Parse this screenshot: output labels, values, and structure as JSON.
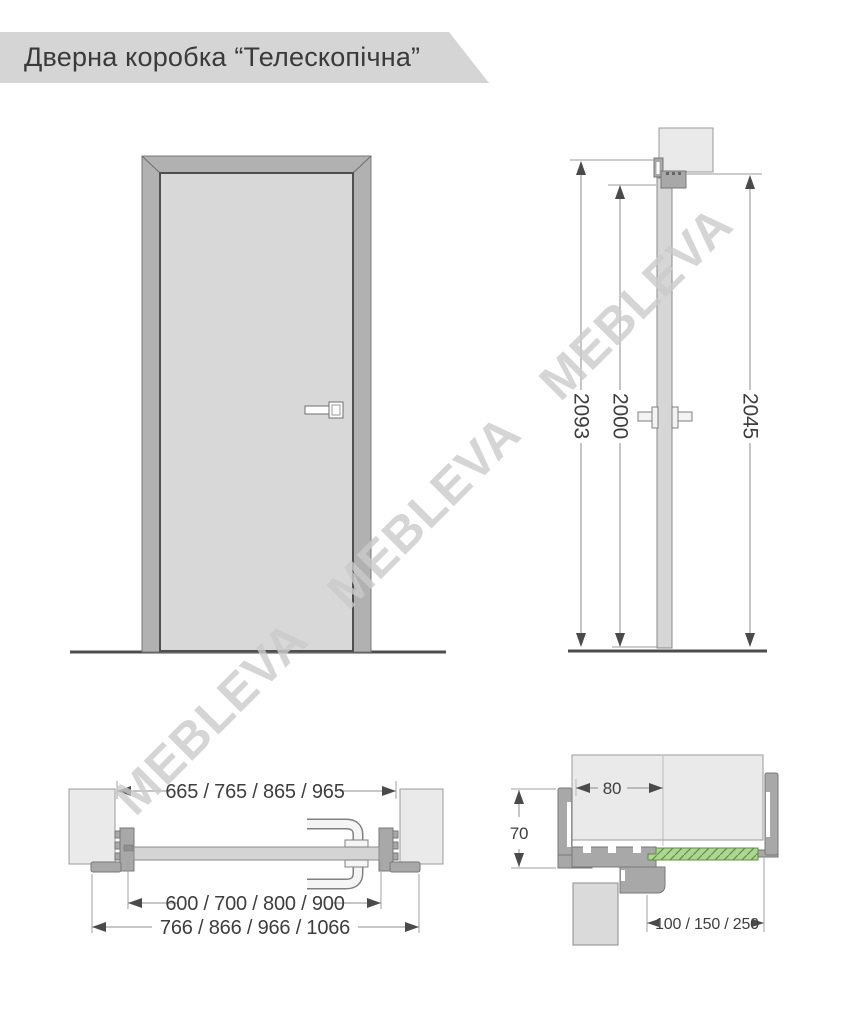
{
  "header": {
    "title": "Дверна коробка “Телескопічна”"
  },
  "watermark": {
    "text": "MEBLEVA"
  },
  "views": {
    "side": {
      "dim_frame_height": "2093",
      "dim_opening_height": "2000",
      "dim_door_height": "2045"
    },
    "plan": {
      "dim_frame_width": "665 / 765 / 865 / 965",
      "dim_door_width": "600 / 700 / 800 / 900",
      "dim_overall_width": "766 / 866 / 966 / 1066"
    },
    "detail": {
      "dim_frame_depth": "80",
      "dim_casing_width": "70",
      "dim_extension_width": "100 / 150 / 250"
    }
  },
  "colors": {
    "wall_gray": "#eaeaea",
    "frame_gray": "#a8a8a8",
    "leaf_gray": "#d8d8d8",
    "extension_green": "#aed693",
    "hatch_green": "#5f8f44"
  }
}
